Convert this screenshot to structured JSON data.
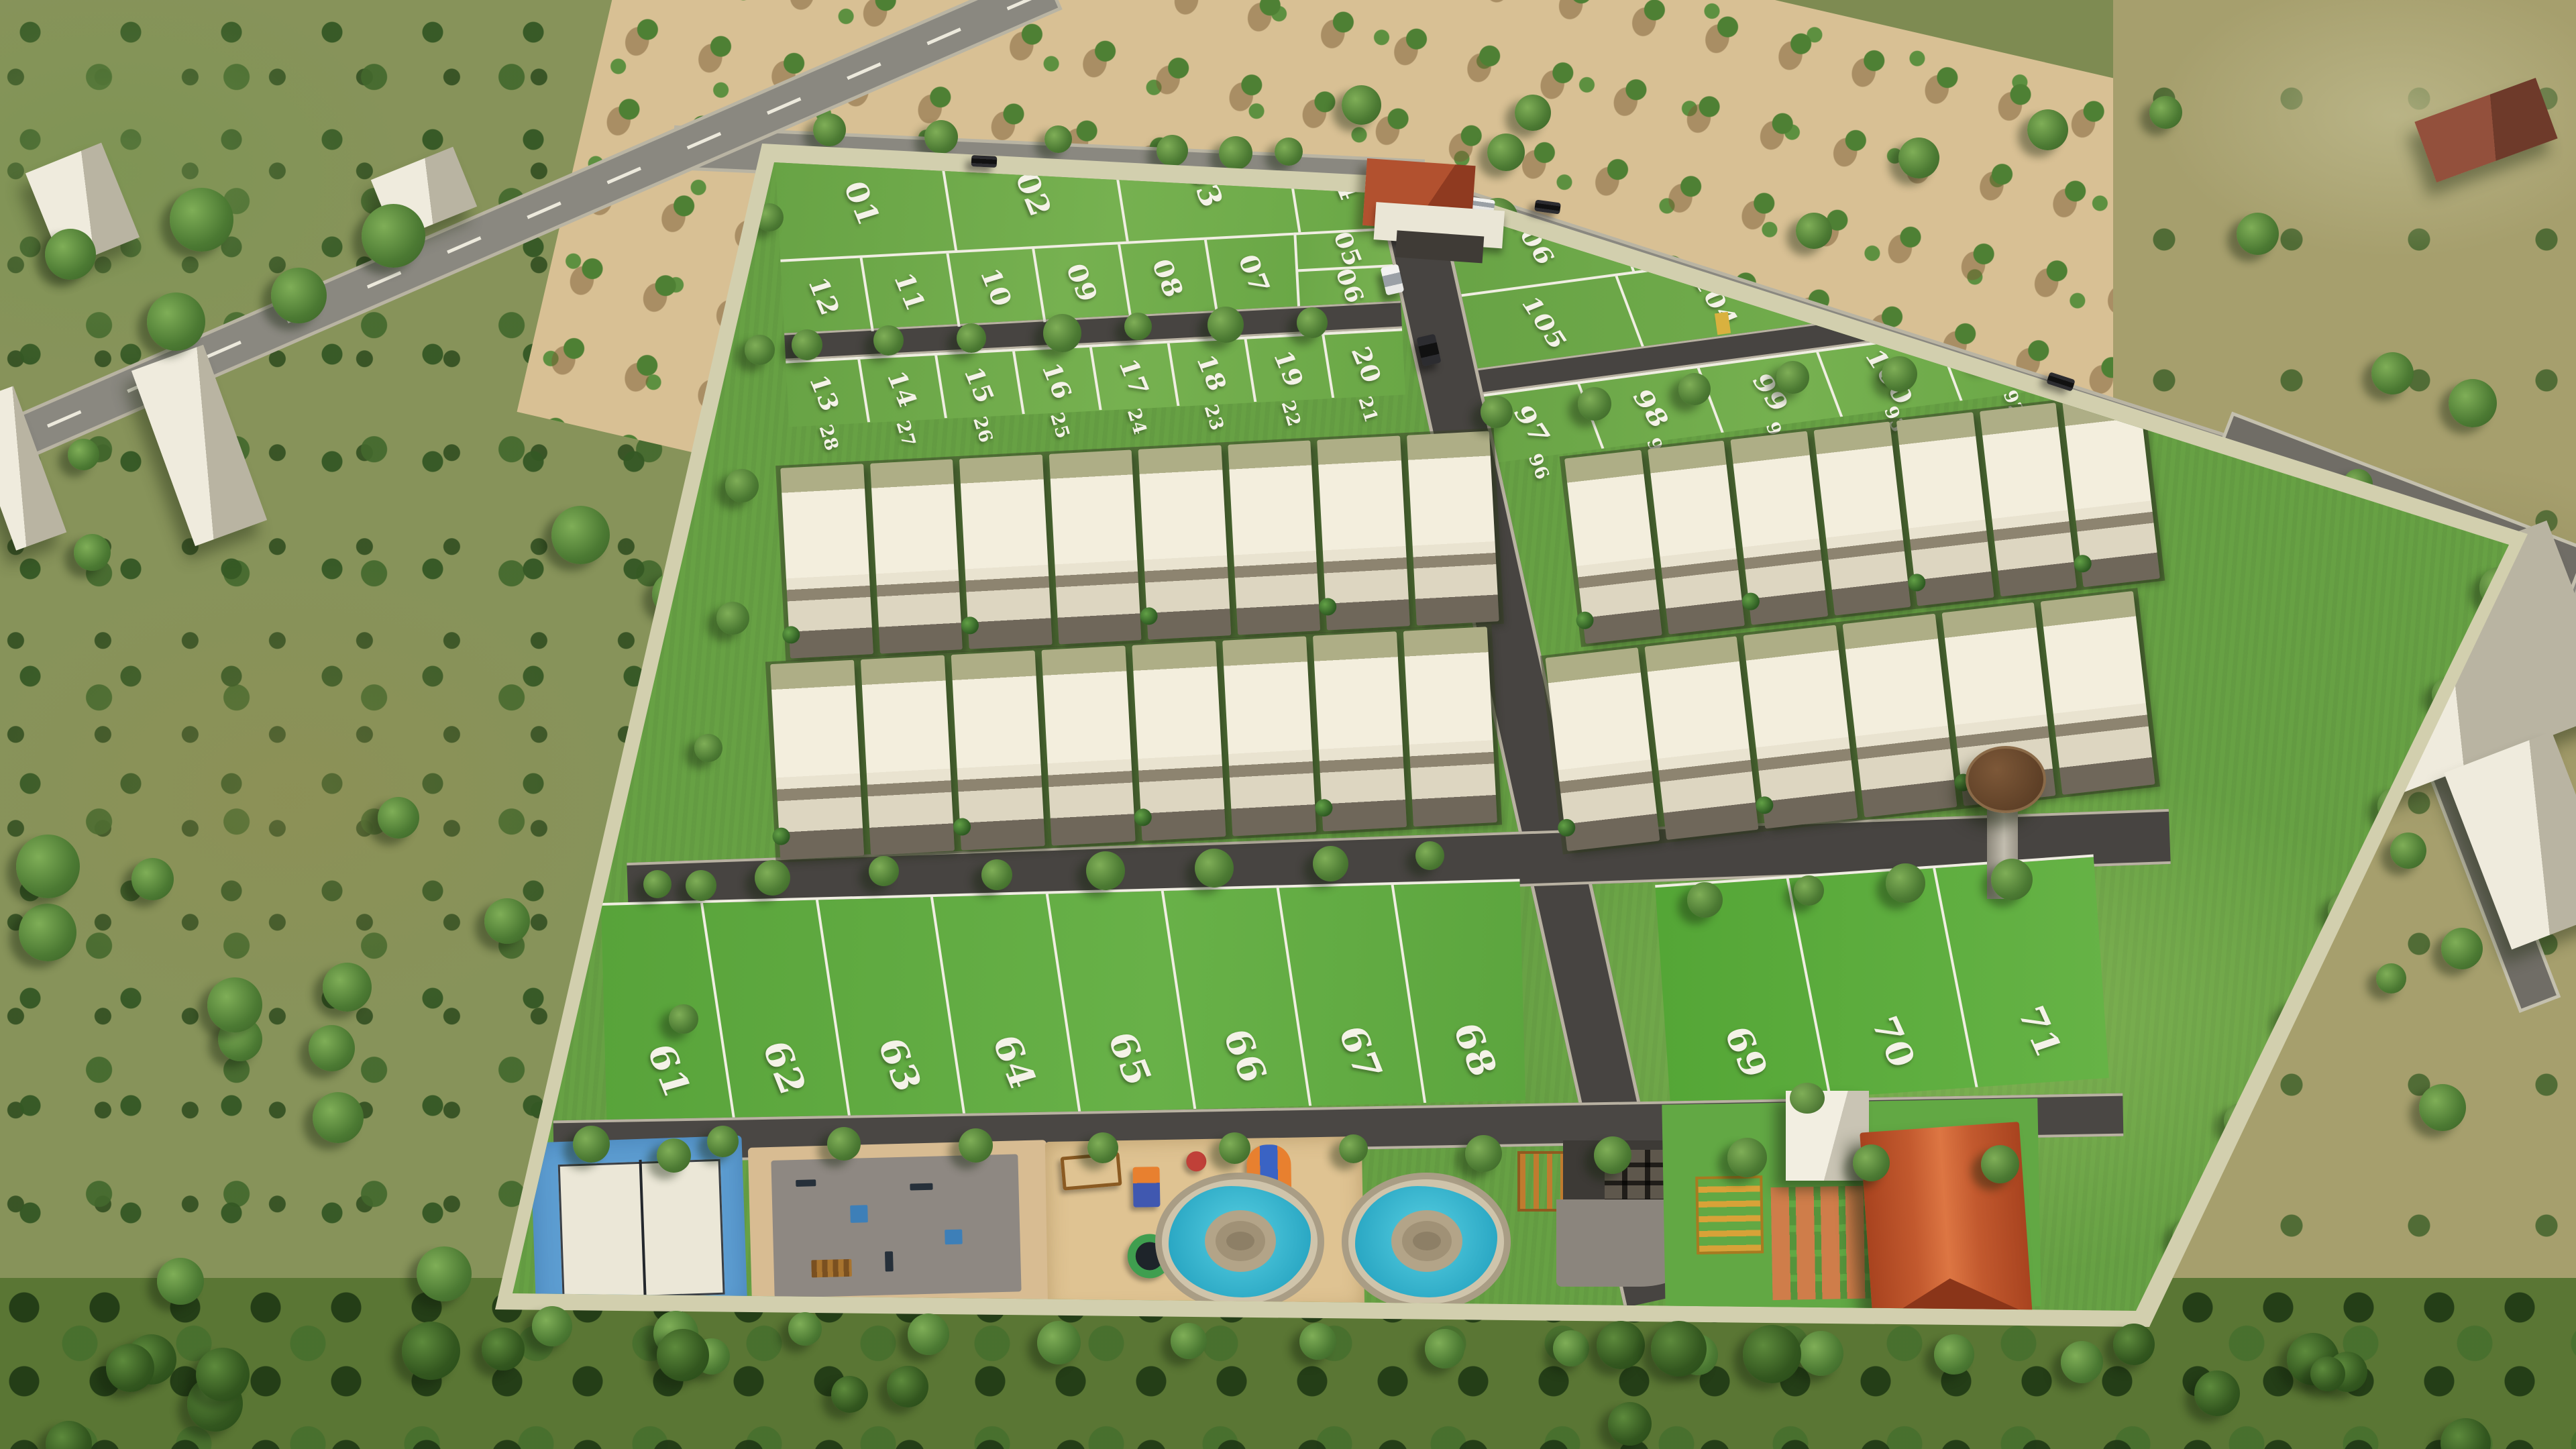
{
  "scene": {
    "type": "aerial-3d-render",
    "subject": "Gated plotted residential development with villas, open plots and amenity zone",
    "visible_text": "white painted plot numbers on grass"
  },
  "plots": {
    "top_left": {
      "row1": [
        "01",
        "02",
        "03",
        "04"
      ],
      "row2": [
        "12",
        "11",
        "10",
        "09",
        "08",
        "07"
      ],
      "row2_side": [
        "05",
        "06"
      ],
      "row3": [
        "13",
        "14",
        "15",
        "16",
        "17",
        "18",
        "19",
        "20"
      ]
    },
    "top_right": {
      "row1": [
        "106",
        "107",
        "108",
        "109"
      ],
      "row2": [
        "105",
        "104",
        "103",
        "102",
        "110",
        "111"
      ],
      "row3": [
        "97",
        "98",
        "99",
        "100",
        "101"
      ]
    },
    "villa_row_left": [
      "28",
      "27",
      "26",
      "25",
      "24",
      "23",
      "22",
      "21"
    ],
    "villa_row_right": [
      "96",
      "95",
      "94",
      "93",
      "92"
    ],
    "bottom_left": [
      "61",
      "62",
      "63",
      "64",
      "65",
      "66",
      "67",
      "68"
    ],
    "bottom_right": [
      "69",
      "70",
      "71"
    ]
  },
  "villas": {
    "left_rows": [
      8,
      8
    ],
    "right_rows": [
      7,
      6
    ]
  },
  "amenities": [
    "entrance-gate",
    "tennis-court",
    "outdoor-gym",
    "kids-playground",
    "trampoline",
    "splash-pad-1",
    "splash-pad-2",
    "pergola-bench",
    "turnaround-pavers",
    "paver-garden",
    "yellow-pergola",
    "utility-cube",
    "clubhouse",
    "water-tower",
    "pavilion"
  ],
  "vehicles": [
    "white-car-main-road",
    "black-car-main-road",
    "dark-car-highway",
    "white-car-entry",
    "dark-car-entry"
  ],
  "colors": {
    "grass": "#67a144",
    "plot_line_white": "#f0eee2",
    "internal_road": "#474441",
    "external_road": "#8a8880",
    "compound_wall": "#d2cfae",
    "sand": "#dfc392",
    "court_blue": "#5d9ed2",
    "splash_water": "#35b9d4",
    "clubhouse_roof": "#c2592e",
    "gate_red": "#a84326",
    "water_tank_brown": "#6e4c30",
    "villa_roof_white": "#f2edda",
    "orchard_sand": "#d8c094",
    "left_field_olive": "#87935a"
  }
}
